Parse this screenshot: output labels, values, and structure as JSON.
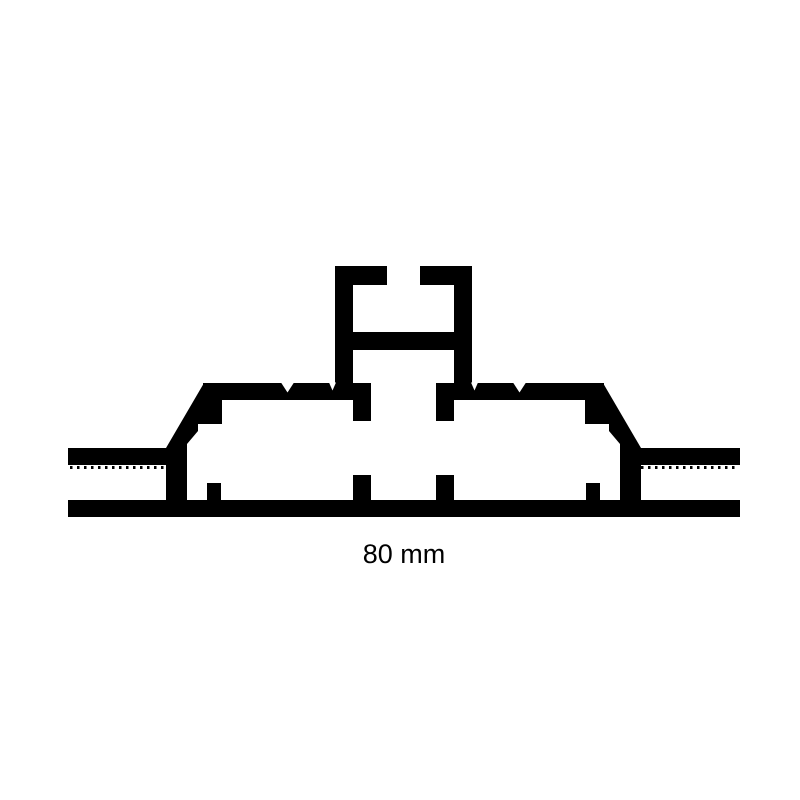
{
  "diagram": {
    "dimension_label": "80 mm",
    "ink_color": "#000000",
    "background_color": "#ffffff"
  }
}
